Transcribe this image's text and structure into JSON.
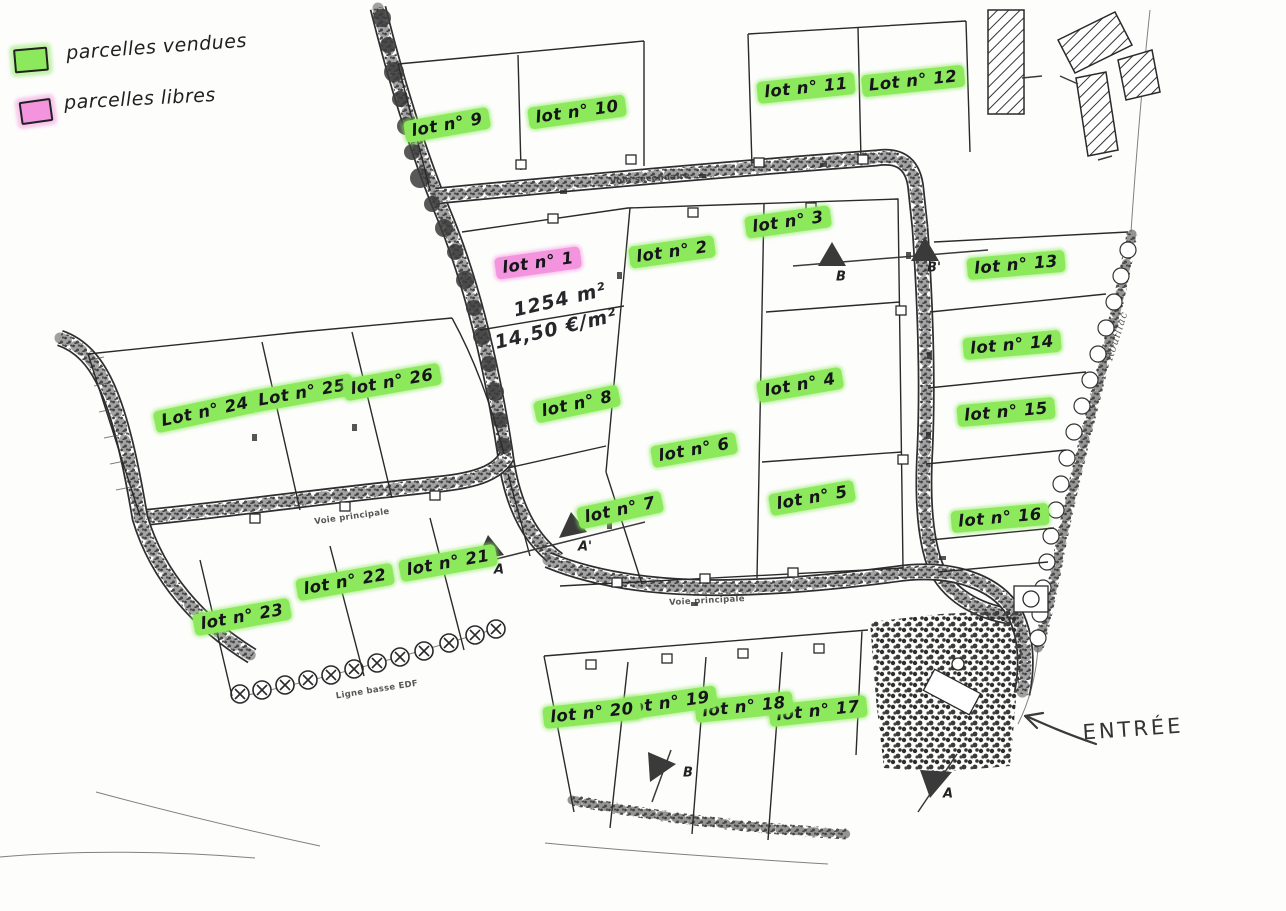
{
  "meta": {
    "title": "Plan de lotissement - parcelles"
  },
  "colors": {
    "sold_highlight": "#8ce95c",
    "free_highlight": "#f493de",
    "ink": "#2a2a2a"
  },
  "legend": {
    "items": [
      {
        "label": "parcelles vendues",
        "swatch_color": "#8ce95c",
        "swatch_style": "background:#8ce95c;box-shadow:0 0 3px 4px rgba(140,233,92,.5)"
      },
      {
        "label": "parcelles libres",
        "swatch_color": "#f493de",
        "swatch_style": "background:#f493de;box-shadow:0 0 3px 4px rgba(244,147,222,.5)"
      }
    ]
  },
  "lot1_details": {
    "area": "1254 m²",
    "price": "14,50 €/m²"
  },
  "entrance": {
    "label": "ENTRÉE"
  },
  "lots": [
    {
      "num": 1,
      "label": "lot n° 1",
      "status": "libre",
      "x": 538,
      "y": 263,
      "r": -8
    },
    {
      "num": 2,
      "label": "lot n° 2",
      "status": "vendue",
      "x": 672,
      "y": 252,
      "r": -8
    },
    {
      "num": 3,
      "label": "lot n° 3",
      "status": "vendue",
      "x": 788,
      "y": 222,
      "r": -8
    },
    {
      "num": 4,
      "label": "lot n° 4",
      "status": "vendue",
      "x": 800,
      "y": 385,
      "r": -10
    },
    {
      "num": 5,
      "label": "lot n° 5",
      "status": "vendue",
      "x": 812,
      "y": 498,
      "r": -10
    },
    {
      "num": 6,
      "label": "lot n° 6",
      "status": "vendue",
      "x": 694,
      "y": 450,
      "r": -10
    },
    {
      "num": 7,
      "label": "lot n° 7",
      "status": "vendue",
      "x": 620,
      "y": 510,
      "r": -12
    },
    {
      "num": 8,
      "label": "lot n° 8",
      "status": "vendue",
      "x": 577,
      "y": 404,
      "r": -12
    },
    {
      "num": 9,
      "label": "lot n° 9",
      "status": "vendue",
      "x": 447,
      "y": 125,
      "r": -10
    },
    {
      "num": 10,
      "label": "lot n° 10",
      "status": "vendue",
      "x": 577,
      "y": 112,
      "r": -8
    },
    {
      "num": 11,
      "label": "lot n° 11",
      "status": "vendue",
      "x": 806,
      "y": 88,
      "r": -6
    },
    {
      "num": 12,
      "label": "Lot n° 12",
      "status": "vendue",
      "x": 913,
      "y": 81,
      "r": -6
    },
    {
      "num": 13,
      "label": "lot n° 13",
      "status": "vendue",
      "x": 1016,
      "y": 265,
      "r": -5
    },
    {
      "num": 14,
      "label": "lot n° 14",
      "status": "vendue",
      "x": 1012,
      "y": 345,
      "r": -5
    },
    {
      "num": 15,
      "label": "lot n° 15",
      "status": "vendue",
      "x": 1006,
      "y": 412,
      "r": -5
    },
    {
      "num": 16,
      "label": "lot n° 16",
      "status": "vendue",
      "x": 1000,
      "y": 518,
      "r": -5
    },
    {
      "num": 17,
      "label": "lot n° 17",
      "status": "vendue",
      "x": 818,
      "y": 711,
      "r": -6
    },
    {
      "num": 18,
      "label": "lot n° 18",
      "status": "vendue",
      "x": 744,
      "y": 707,
      "r": -6
    },
    {
      "num": 19,
      "label": "lot n° 19",
      "status": "vendue",
      "x": 668,
      "y": 703,
      "r": -8
    },
    {
      "num": 20,
      "label": "lot n° 20",
      "status": "vendue",
      "x": 592,
      "y": 713,
      "r": -6
    },
    {
      "num": 21,
      "label": "lot n° 21",
      "status": "vendue",
      "x": 448,
      "y": 563,
      "r": -10
    },
    {
      "num": 22,
      "label": "lot n° 22",
      "status": "vendue",
      "x": 345,
      "y": 582,
      "r": -10
    },
    {
      "num": 23,
      "label": "lot n° 23",
      "status": "vendue",
      "x": 242,
      "y": 617,
      "r": -10
    },
    {
      "num": 24,
      "label": "Lot n° 24",
      "status": "vendue",
      "x": 205,
      "y": 412,
      "r": -12
    },
    {
      "num": 25,
      "label": "Lot n° 25",
      "status": "vendue",
      "x": 302,
      "y": 393,
      "r": -10
    },
    {
      "num": 26,
      "label": "lot n° 26",
      "status": "vendue",
      "x": 392,
      "y": 382,
      "r": -10
    }
  ],
  "road_labels": [
    {
      "label": "Voie secondaire",
      "x": 650,
      "y": 179,
      "r": -4
    },
    {
      "label": "Voie principale",
      "x": 707,
      "y": 601,
      "r": -3
    },
    {
      "label": "Voie principale",
      "x": 352,
      "y": 517,
      "r": -8
    },
    {
      "label": "Ligne basse EDF",
      "x": 377,
      "y": 690,
      "r": -9
    },
    {
      "label": "Rouillac",
      "status": "streamname",
      "x": 1117,
      "y": 336,
      "r": -72
    }
  ],
  "marker_letters": [
    {
      "label": "B",
      "x": 841,
      "y": 277
    },
    {
      "label": "B'",
      "x": 934,
      "y": 268
    },
    {
      "label": "A'",
      "x": 585,
      "y": 547
    },
    {
      "label": "A",
      "x": 499,
      "y": 570
    },
    {
      "label": "B",
      "x": 688,
      "y": 773
    },
    {
      "label": "A",
      "x": 948,
      "y": 794
    }
  ]
}
